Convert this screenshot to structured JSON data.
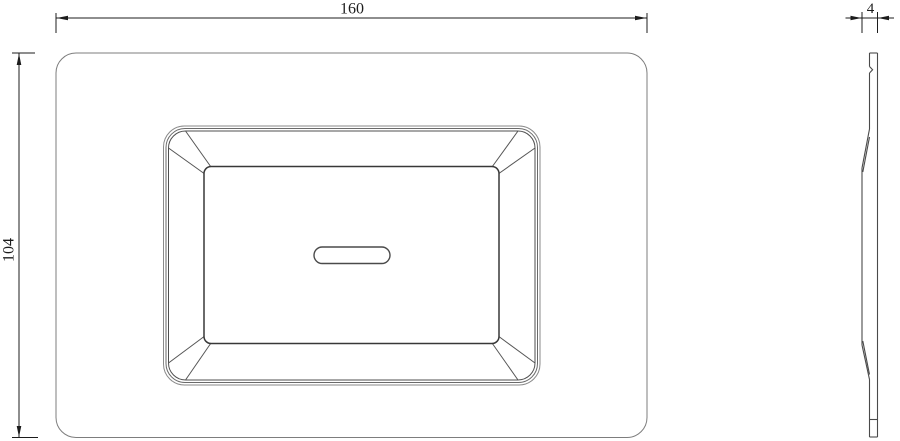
{
  "drawing": {
    "dimensions": {
      "width": {
        "value": "160"
      },
      "height": {
        "value": "104"
      },
      "thickness": {
        "value": "4"
      }
    },
    "colors": {
      "background": "#ffffff",
      "plate_outline": "#7d7d7d",
      "detail_line": "#4a4a4a",
      "dimension_line": "#1c1c1c"
    }
  }
}
